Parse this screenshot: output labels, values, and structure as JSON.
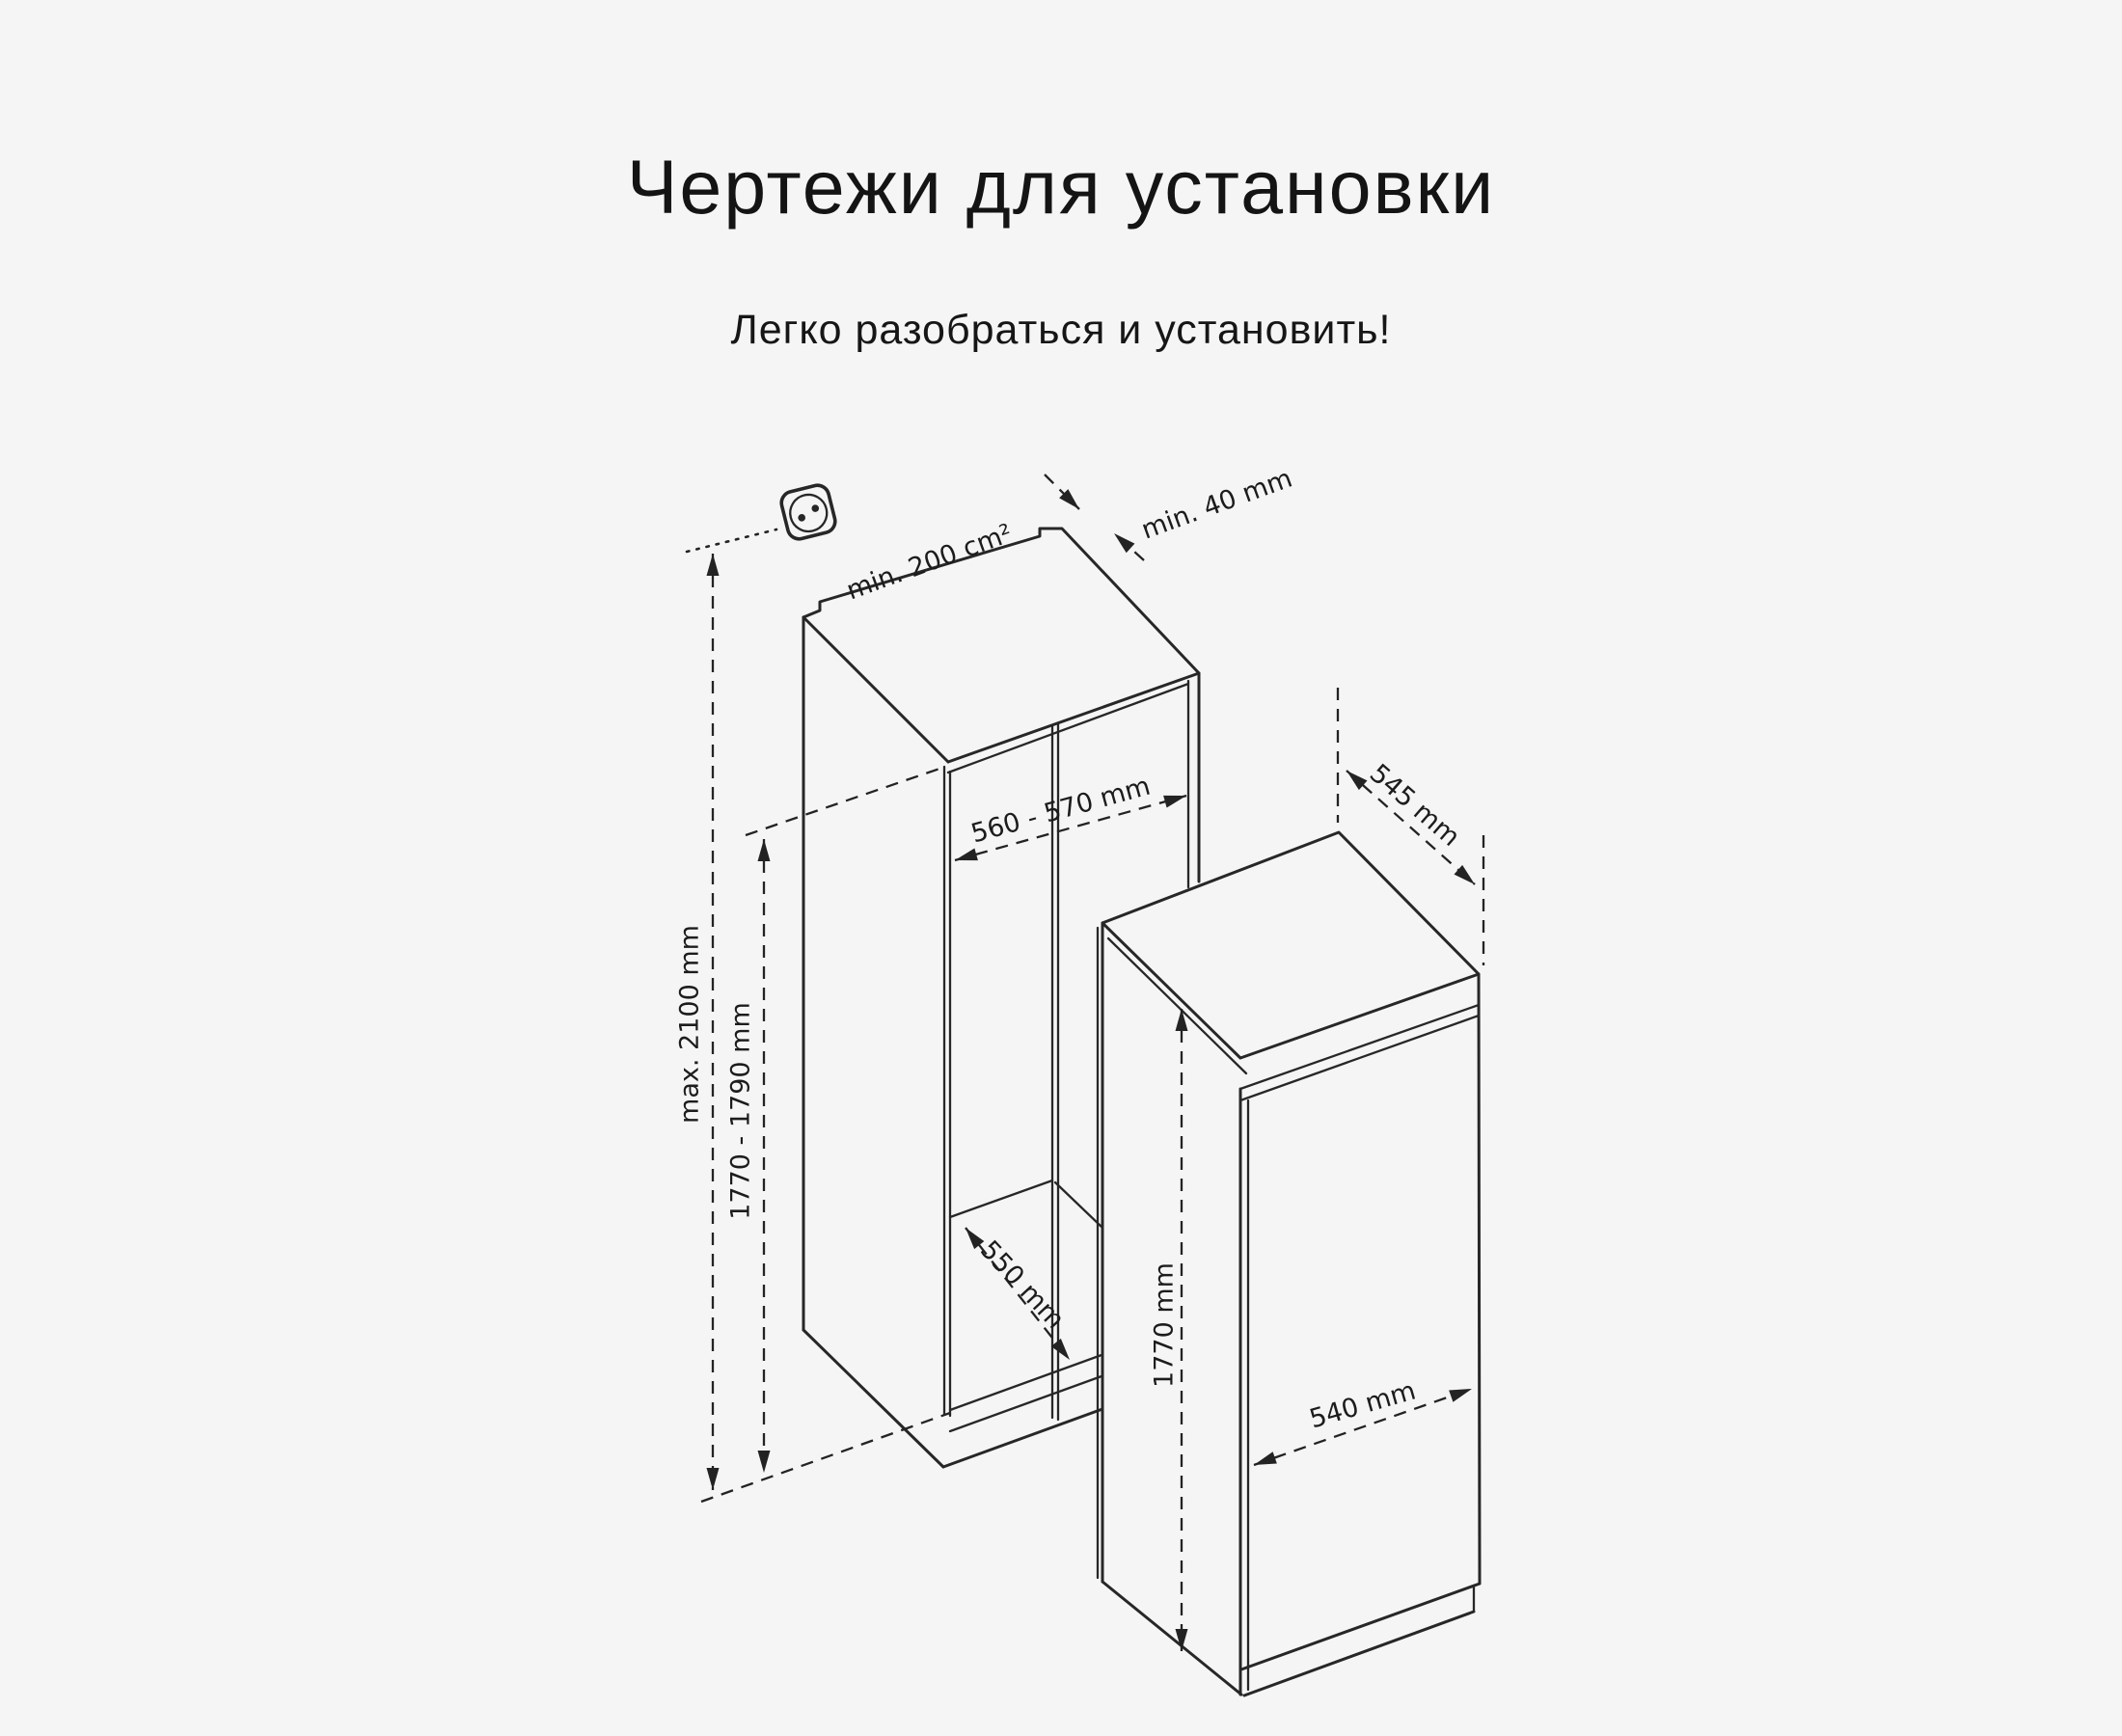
{
  "page": {
    "background": "#f5f5f6",
    "title": "Чертежи для установки",
    "subtitle": "Легко разобраться и установить!"
  },
  "diagram": {
    "line_color": "#272727",
    "icons": {
      "outlet_icon": "power-outlet"
    },
    "niche": {
      "vent_area": "min. 200 cm²",
      "rear_gap": "min. 40 mm",
      "width": "560 - 570 mm",
      "max_height": "max. 2100 mm",
      "inner_height": "1770 - 1790 mm",
      "depth": "550 mm"
    },
    "fridge": {
      "depth": "545 mm",
      "height": "1770 mm",
      "width": "540 mm"
    }
  }
}
